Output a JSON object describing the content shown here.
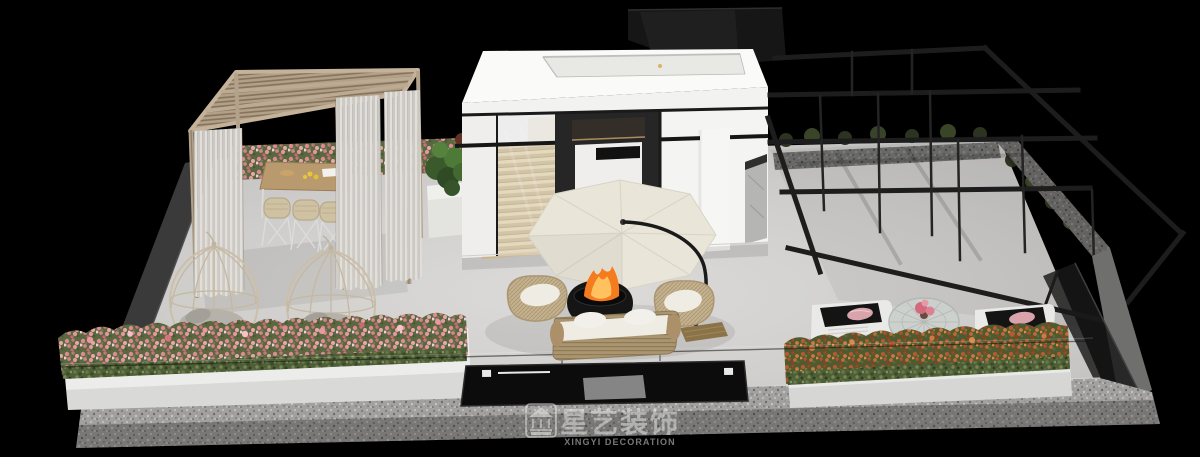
{
  "meta": {
    "title": "Rooftop terrace 3D design render"
  },
  "watermark": {
    "brand_cn": "星艺装饰",
    "brand_en": "XINGYI DECORATION",
    "logo": "pavilion-icon"
  },
  "colors": {
    "background": "#000000",
    "floor_light": "#d9d8d6",
    "floor_dark": "#c3c2c0",
    "granite": "#a2a19f",
    "building_white": "#fafaf8",
    "frame_black": "#1d1d1d",
    "wood_pergola": "#b2a089",
    "curtain": "#dbd8d3",
    "umbrella_canopy": "#e9e6d9",
    "fire": "#f47b1e",
    "fire_core": "#ffc25e",
    "flowers_pink": "#dd8b92",
    "flowers_orange": "#b65a31",
    "rattan": "#c8b795",
    "cushion_white": "#efece4",
    "watermark": "rgba(235,235,235,0.5)"
  },
  "scene": {
    "areas": [
      {
        "name": "wood-pergola-dining",
        "desc": "slatted wood pergola with sheer curtains over a dining table and rattan chairs"
      },
      {
        "name": "hanging-egg-chairs",
        "desc": "two cage-style hanging chairs with grey cushions"
      },
      {
        "name": "stair-pavilion",
        "desc": "white flat-roof stair enclosure with glass door, wood stairs and roof skylight"
      },
      {
        "name": "fire-lounge",
        "desc": "cream cantilever umbrella over a fire bowl with rattan sofa and two chairs"
      },
      {
        "name": "steel-pergola",
        "desc": "open black steel grid pergola frame"
      },
      {
        "name": "sun-loungers",
        "desc": "two white loungers with black pads and a round woven table"
      },
      {
        "name": "planters",
        "desc": "white planters with pink and orange flowers behind a glass balustrade"
      },
      {
        "name": "sunken-skylight",
        "desc": "dark recessed glass panel in the terrace apron"
      }
    ]
  }
}
